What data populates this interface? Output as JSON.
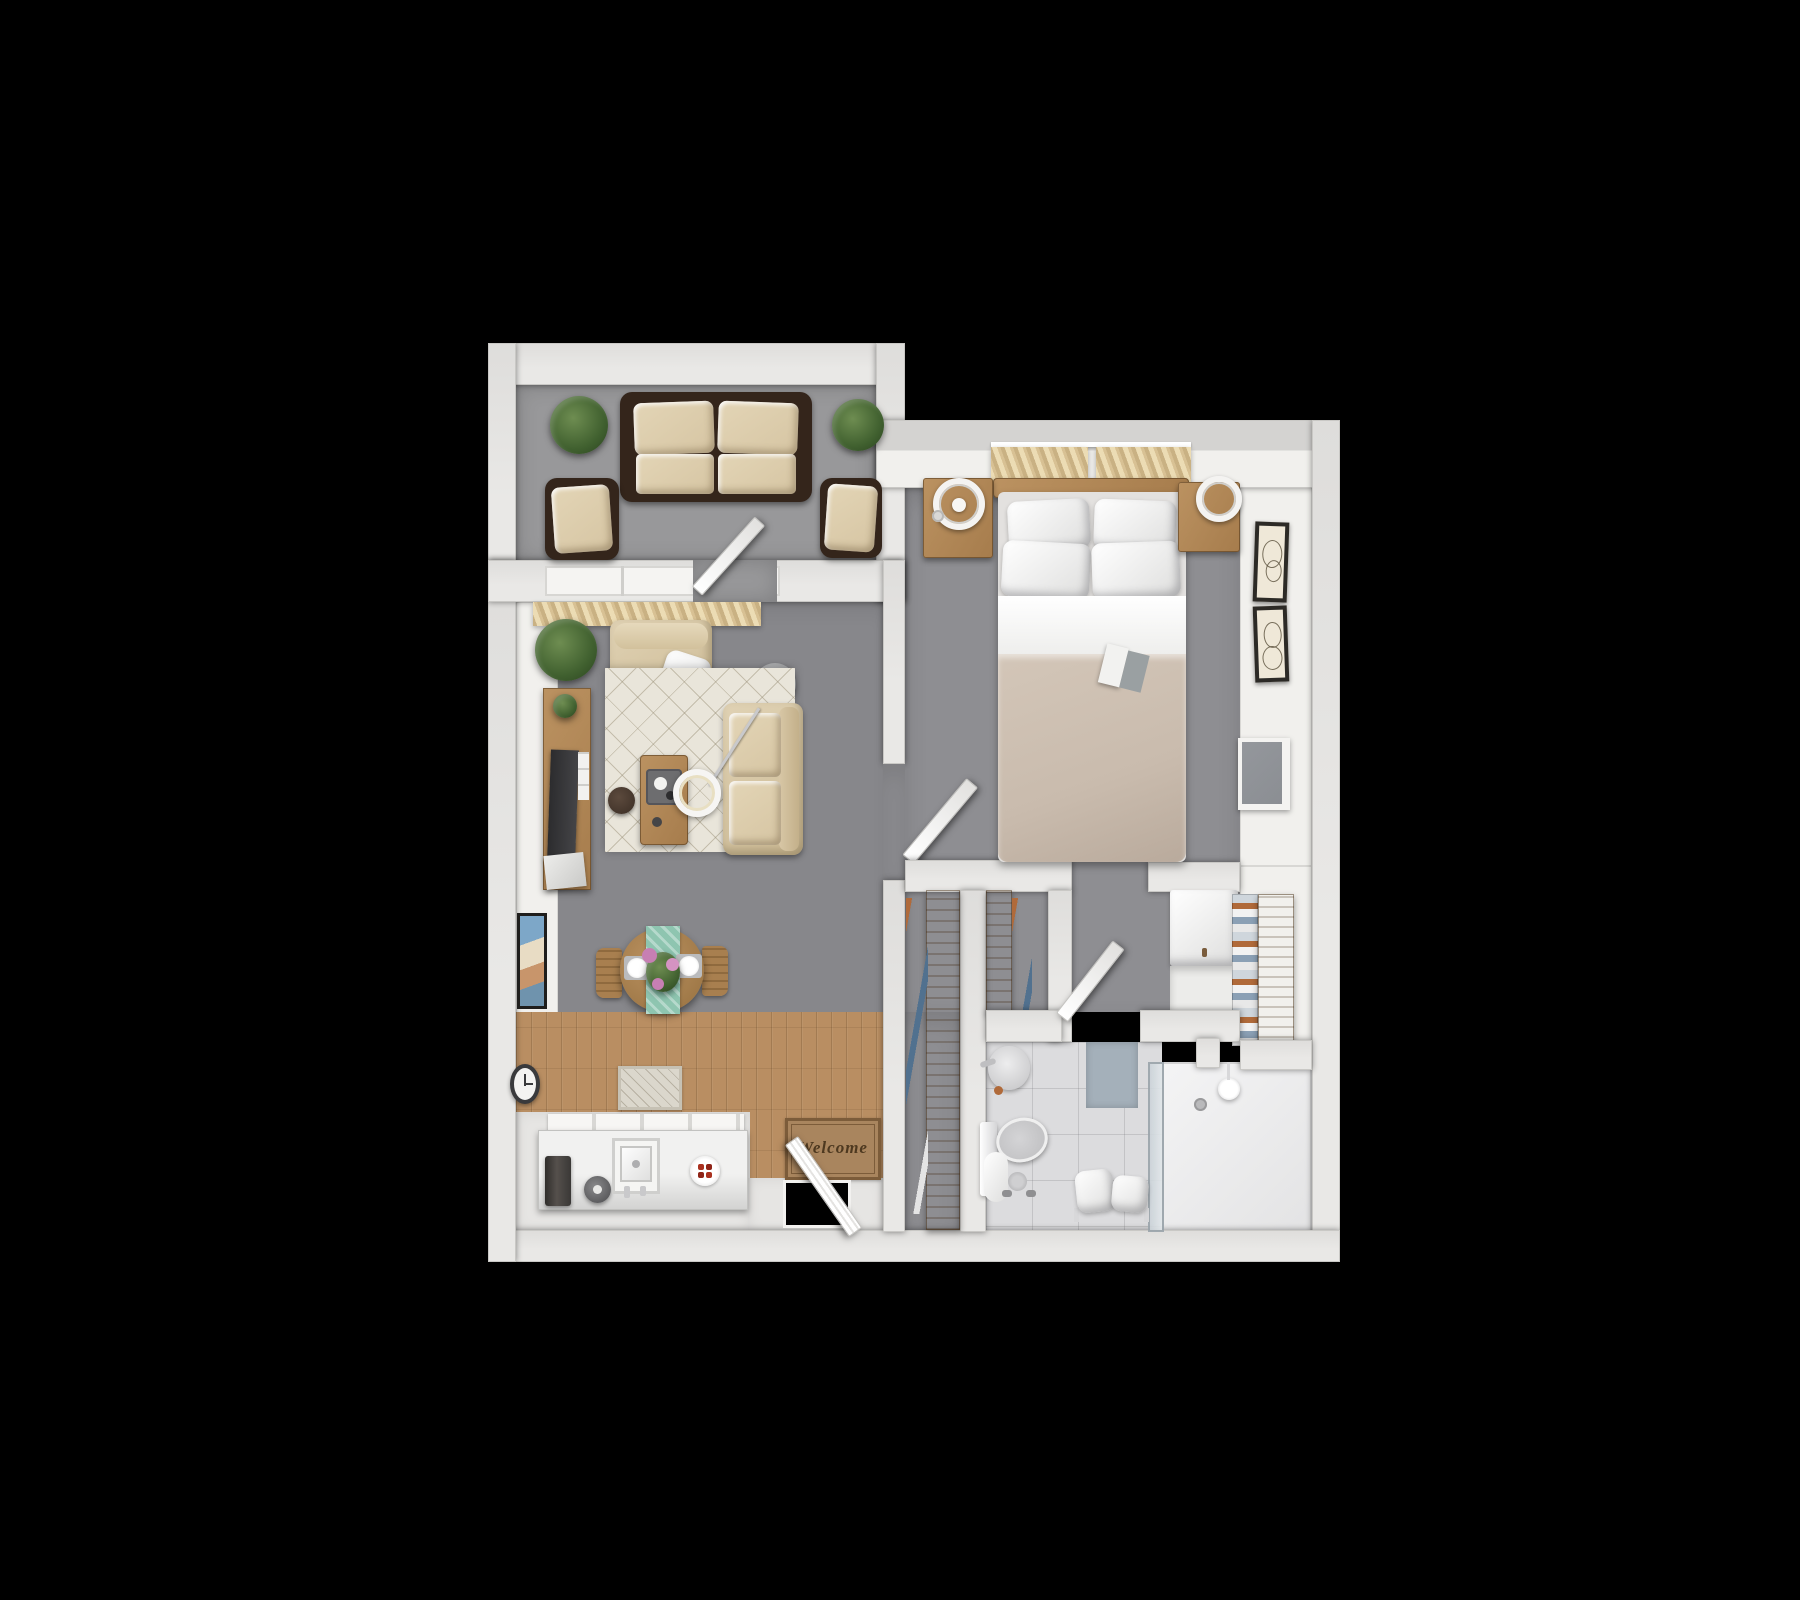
{
  "meta": {
    "type": "3d-floor-plan-top-view",
    "style": "rendered apartment floor plan on black background"
  },
  "welcome_mat": {
    "text": "Welcome"
  },
  "palette": {
    "background": "#000000",
    "wall": "#e9e8e6",
    "wall_edge": "#c9c8c5",
    "patio_carpet": "#98989a",
    "living_carpet": "#87878b",
    "bedroom_carpet": "#8e8e92",
    "wood_floor": "#b98e62",
    "wood_furniture": "#ab8050",
    "rug_cream": "#e9e5da",
    "cushion_beige": "#d6c5a3",
    "wicker_brown": "#34251b",
    "blanket_taupe": "#c9bbad",
    "accent_teal": "#8ec5b0",
    "tile_floor": "#dcdcde",
    "glass": "#c8d0d6",
    "tv_gray": "#8b8e93",
    "mat_brown": "#a9855e",
    "bath_mat_blue": "#a4b0ba",
    "plant_green": "#40602f",
    "flower_pink": "#c77fb3",
    "clothes_orange": "#b06a3a",
    "clothes_blue": "#51718f",
    "appliance_dark": "#3a3836",
    "knob_red": "#a9311f"
  },
  "rooms": [
    {
      "id": "patio",
      "label": "patio",
      "items": [
        "potted-plant",
        "wicker-sofa",
        "seat-cushions",
        "wicker-armchair",
        "wicker-armchair",
        "potted-plant",
        "patio-door"
      ]
    },
    {
      "id": "living-room",
      "label": "living room",
      "items": [
        "window-curtains",
        "potted-plant",
        "armchair",
        "throw-pillow",
        "round-side-table",
        "arc-floor-lamp",
        "area-rug",
        "sofa",
        "coffee-table",
        "pouf",
        "tv-stand",
        "television",
        "wall-art",
        "wall-clock"
      ]
    },
    {
      "id": "dining-kitchen",
      "label": "dining and kitchen",
      "items": [
        "dining-table",
        "teal-table-runner",
        "flower-centerpiece",
        "place-setting",
        "place-setting",
        "dining-chair",
        "dining-chair",
        "kitchen-counter",
        "upper-cabinets",
        "coffee-machine",
        "kettle",
        "kitchen-sink",
        "cooktop-burner",
        "small-rug",
        "welcome-mat",
        "entry-door"
      ]
    },
    {
      "id": "bedroom",
      "label": "bedroom",
      "items": [
        "window-curtains",
        "headboard",
        "double-bed",
        "pillows",
        "duvet",
        "open-book",
        "nightstand",
        "round-lamp",
        "nightstand",
        "round-lamp",
        "framed-art",
        "framed-art",
        "wall-television",
        "bedroom-door"
      ]
    },
    {
      "id": "closet",
      "label": "walk-through closet",
      "items": [
        "wardrobe-rail",
        "hanging-clothes",
        "wardrobe-rail",
        "hanging-clothes",
        "linen-cabinet",
        "folded-clothes-shelf",
        "wardrobe-panel"
      ]
    },
    {
      "id": "bathroom",
      "label": "bathroom",
      "items": [
        "pedestal-sink",
        "toilet",
        "toilet-paper-stand",
        "bath-mat",
        "towel-bench",
        "shower-glass",
        "shower",
        "shower-head",
        "floor-drain",
        "bathroom-door"
      ]
    }
  ]
}
